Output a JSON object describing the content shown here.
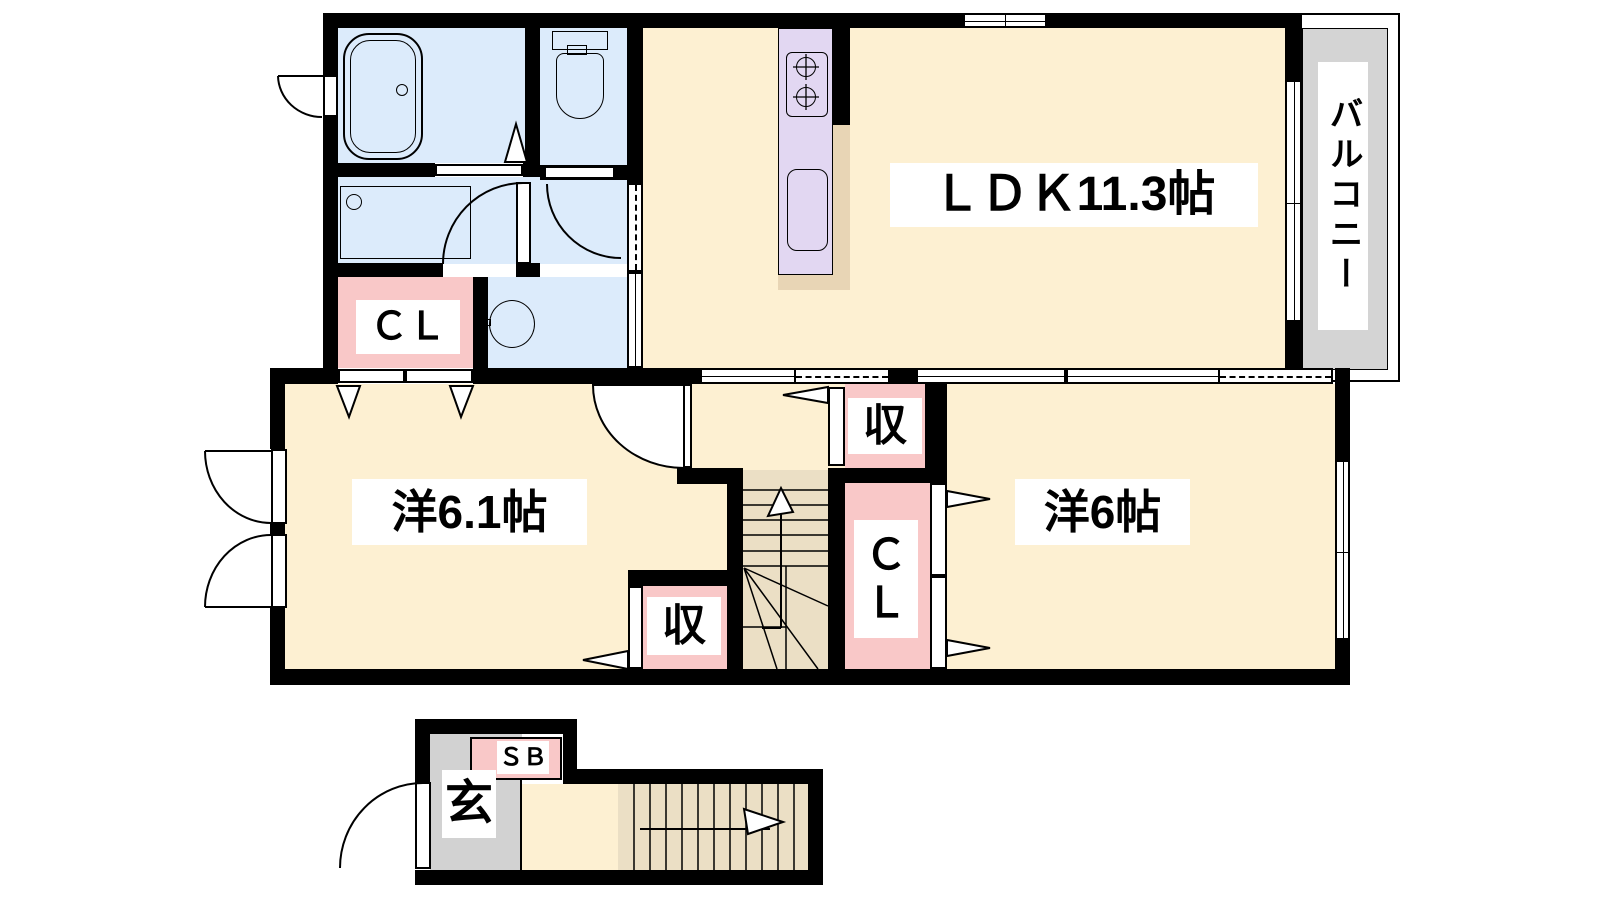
{
  "title": "2F apartment floor plan (2LDK)",
  "labels": {
    "ldk": "ＬＤＫ11.3帖",
    "room_left": "洋6.1帖",
    "room_right": "洋6帖",
    "balcony": "バルコニー",
    "closet_upper": "ＣＬ",
    "storage_hall": "収",
    "closet_center_line1": "Ｃ",
    "closet_center_line2": "Ｌ",
    "storage_lower": "収",
    "shoe_box": "ＳＢ",
    "entrance": "玄"
  },
  "colors": {
    "wall": "#000000",
    "room-cream": "#fdf0d2",
    "wet-blue": "#dcebfb",
    "closet-pink": "#f9c8c8",
    "counter-lavender": "#e2d7f2",
    "kitchen-tan": "#e8d5b5",
    "stairs-tan": "#ebdfc5",
    "balcony-gray": "#d4d4d4",
    "genkan-gray": "#d2d2d2"
  }
}
